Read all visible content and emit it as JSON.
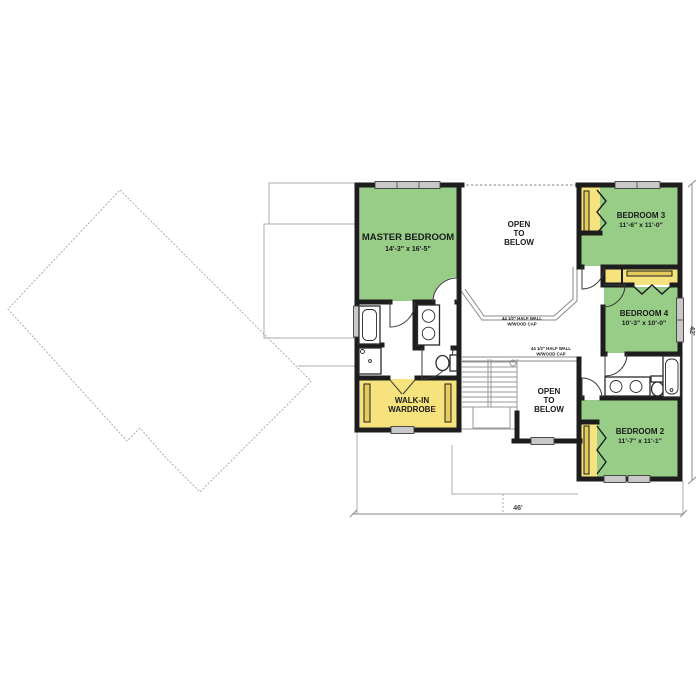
{
  "title": "Upper floor plan",
  "colors": {
    "room_green": "#97cd86",
    "closet_yellow": "#f6e37e",
    "rod_gold": "#e5cb5e",
    "wall_black": "#1d1d1d",
    "window_gray": "#c9c9c9",
    "outline_gray": "#adadad",
    "dimension_gray": "#8a8a8a"
  },
  "rooms": {
    "master": {
      "name": "MASTER BEDROOM",
      "dims": "14'-3\" x 16'-5\""
    },
    "bedroom3": {
      "name": "BEDROOM 3",
      "dims": "11'-6\" x 11'-0\""
    },
    "bedroom4": {
      "name": "BEDROOM 4",
      "dims": "10'-3\" x 10'-0\""
    },
    "bedroom2": {
      "name": "BEDROOM 2",
      "dims": "11'-7\" x 11'-1\""
    },
    "wardrobe": {
      "line1": "WALK-IN",
      "line2": "WARDROBE"
    }
  },
  "open_below": {
    "line1": "OPEN",
    "line2": "TO",
    "line3": "BELOW"
  },
  "half_wall": {
    "line1": "44 1/2\" HALF WALL",
    "line2": "W/WOOD CAP"
  },
  "dimensions": {
    "width": "46'",
    "height": "42'"
  }
}
